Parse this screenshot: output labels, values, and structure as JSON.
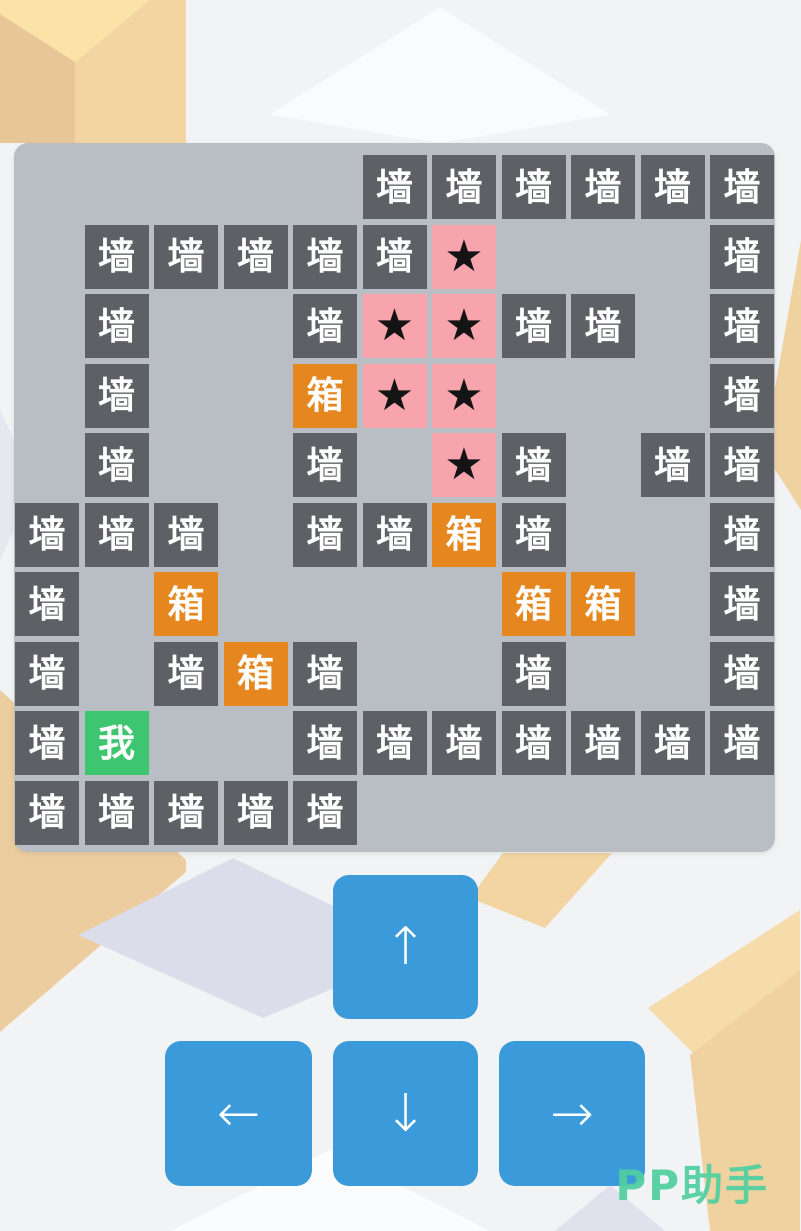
{
  "page": {
    "background_color": "#f2f3f5",
    "watermark": "PP助手",
    "watermark_color": "#50cfa0"
  },
  "board": {
    "background_color": "#b8bec4",
    "rows": 10,
    "cols": 11,
    "legend": {
      "W": {
        "label": "墙",
        "meaning": "wall",
        "bg": "#5d6064",
        "fg": "#ffffff"
      },
      "B": {
        "label": "箱",
        "meaning": "box",
        "bg": "#e5861e",
        "fg": "#ffffff"
      },
      "S": {
        "label": "★",
        "meaning": "goal-star",
        "bg": "#f8a4ac",
        "fg": "#141414"
      },
      "P": {
        "label": "我",
        "meaning": "player",
        "bg": "#3ec56f",
        "fg": "#ffffff"
      }
    },
    "grid": [
      ".....WWWWWW",
      ".WWWWWS...W",
      ".W..WSSWW.W",
      ".W..BSS...W",
      ".W..W.SW.WW",
      "WWW.WWBW..W",
      "W.B....BB.W",
      "W.WBW..W..W",
      "WP..WWWWWWW",
      "WWWWW......"
    ]
  },
  "controls": {
    "button_color": "#3b9ad9",
    "up": "↑",
    "down": "↓",
    "left": "←",
    "right": "→"
  }
}
